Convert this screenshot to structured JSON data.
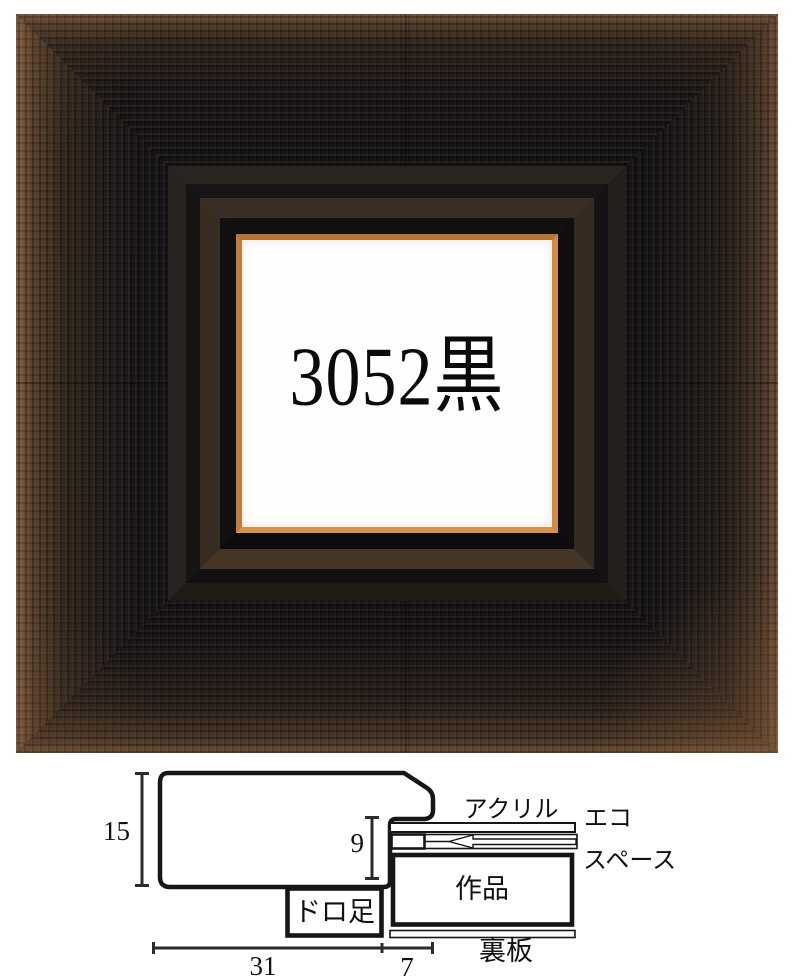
{
  "product": {
    "frame_label": "3052黒"
  },
  "colors": {
    "liner_gold": "#c8873f",
    "wood_dark": "#151316",
    "wood_brown": "#8a6548",
    "diagram_ink": "#161616"
  },
  "diagram": {
    "dims": {
      "moulding_height": "15",
      "rabbet_depth": "9",
      "moulding_width": "31",
      "rabbet_width": "7"
    },
    "labels": {
      "acrylic": "アクリル",
      "eco": "エコ",
      "space": "スペース",
      "artwork": "作品",
      "drop_foot": "ドロ足",
      "back_board": "裏板"
    }
  }
}
